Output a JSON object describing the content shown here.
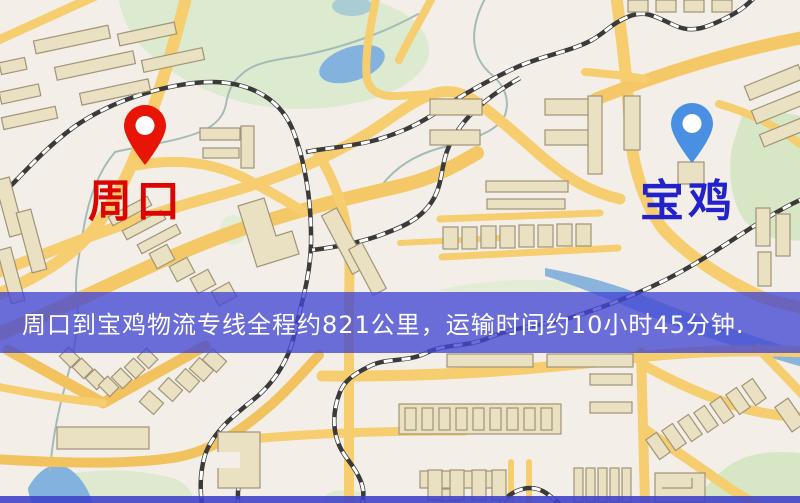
{
  "banner": {
    "text": "周口到宝鸡物流专线全程约821公里，运输时间约10小时45分钟.",
    "distance": "821公里",
    "duration": "10小时45分钟",
    "background": "#4347d4",
    "text_color": "#ffffff"
  },
  "origin": {
    "label": "周口",
    "pin_icon": "location-pin",
    "pin_color": "#e81405",
    "label_color": "#dc0300"
  },
  "destination": {
    "label": "宝鸡",
    "pin_icon": "location-pin",
    "pin_color": "#4a90e2",
    "label_color": "#2222cc"
  },
  "map_palette": {
    "background": "#f3efe8",
    "road": "#f6cd6f",
    "park": "#dcead0",
    "water": "#84b2de",
    "building_fill": "#eae0c2",
    "building_stroke": "#a09478",
    "railway": "#3a3a3a"
  }
}
